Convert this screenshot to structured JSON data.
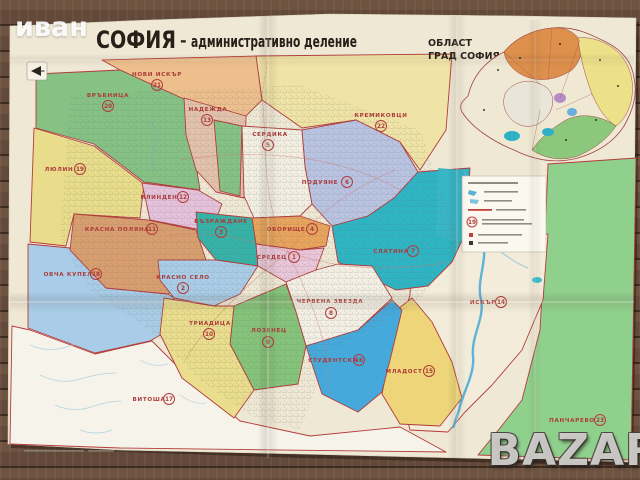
{
  "photo_watermarks": {
    "top_left": "иван",
    "bottom_right": "BAZAR"
  },
  "title": {
    "city": "СОФИЯ",
    "dash": "-",
    "subtitle": "административно деление"
  },
  "inset": {
    "title1": "ОБЛАСТ",
    "title2": "ГРАД СОФИЯ"
  },
  "legend": {
    "sample_number": "19"
  },
  "colors": {
    "paper": "#efe8d5",
    "boundary": "#b23c3c",
    "label": "#ac3a3a",
    "water": "#55b0d6",
    "wood": "#5a4232"
  },
  "districts": [
    {
      "number": "1",
      "name": "СРЕДЕЦ",
      "color": "#eac6da"
    },
    {
      "number": "2",
      "name": "КРАСНО СЕЛО",
      "color": "#a9cde8"
    },
    {
      "number": "3",
      "name": "ВЪЗРАЖДАНЕ",
      "color": "#35b3a8"
    },
    {
      "number": "4",
      "name": "ОБОРИЩЕ",
      "color": "#e8a45c"
    },
    {
      "number": "5",
      "name": "СЕРДИКА",
      "color": "#f2eee2"
    },
    {
      "number": "6",
      "name": "ПОДУЯНЕ",
      "color": "#b9c3e2"
    },
    {
      "number": "7",
      "name": "СЛАТИНА",
      "color": "#2eb5c5"
    },
    {
      "number": "8",
      "name": "ЧЕРВЕНА ЗВЕЗДА",
      "color": "#f3efe5"
    },
    {
      "number": "9",
      "name": "ЛОЗЕНЕЦ",
      "color": "#85c47a"
    },
    {
      "number": "10",
      "name": "ТРИАДИЦА",
      "color": "#eadd8d"
    },
    {
      "number": "11",
      "name": "КРАСНА ПОЛЯНА",
      "color": "#d99e6f"
    },
    {
      "number": "12",
      "name": "ИЛИНДЕН",
      "color": "#e5c1db"
    },
    {
      "number": "13",
      "name": "НАДЕЖДА",
      "color": "#e3c2ab"
    },
    {
      "number": "14",
      "name": "ИСКЪР",
      "color": "#f3ecda"
    },
    {
      "number": "15",
      "name": "МЛАДОСТ",
      "color": "#eed579"
    },
    {
      "number": "16",
      "name": "СТУДЕНТСКА",
      "color": "#46a9dc"
    },
    {
      "number": "17",
      "name": "ВИТОША",
      "color": "#f6f3ea"
    },
    {
      "number": "18",
      "name": "ОВЧА КУПЕЛ",
      "color": "#a9cde8"
    },
    {
      "number": "19",
      "name": "ЛЮЛИН",
      "color": "#e9dd8b"
    },
    {
      "number": "20",
      "name": "ВРЪБНИЦА",
      "color": "#85c284"
    },
    {
      "number": "21",
      "name": "НОВИ ИСКЪР",
      "color": "#edbf8d"
    },
    {
      "number": "22",
      "name": "КРЕМИКОВЦИ",
      "color": "#f0e3a6"
    },
    {
      "number": "23",
      "name": "ПАНЧАРЕВО",
      "color": "#90d08d"
    }
  ]
}
